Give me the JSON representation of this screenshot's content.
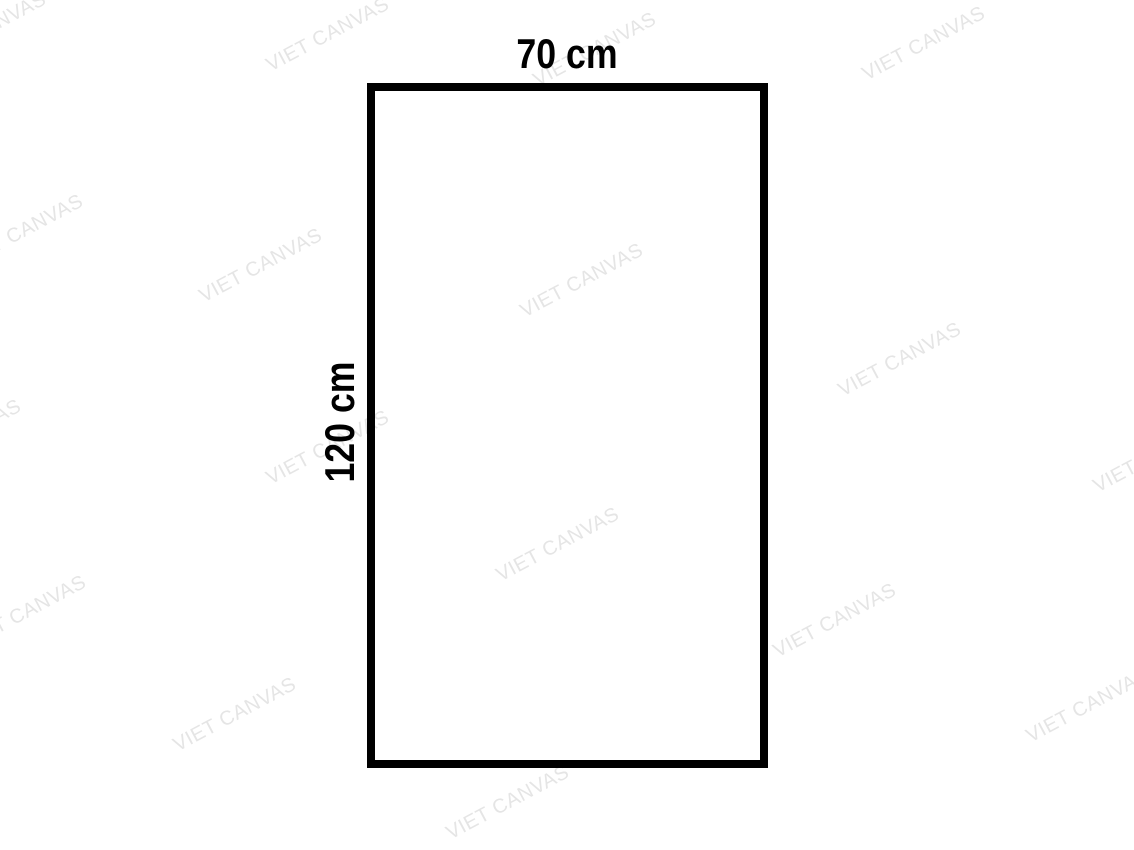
{
  "diagram": {
    "width_label": "70 cm",
    "height_label": "120 cm",
    "outline_color": "#000000",
    "label_color": "#000000",
    "background_color": "#ffffff"
  },
  "watermark": {
    "text": "VIET CANVAS",
    "color": "#e5e5e5",
    "angle_deg": -28,
    "positions": [
      {
        "x": -15,
        "y": 30
      },
      {
        "x": 328,
        "y": 35
      },
      {
        "x": 595,
        "y": 50
      },
      {
        "x": 924,
        "y": 44
      },
      {
        "x": 22,
        "y": 232
      },
      {
        "x": 261,
        "y": 266
      },
      {
        "x": 582,
        "y": 281
      },
      {
        "x": 900,
        "y": 360
      },
      {
        "x": 1155,
        "y": 456
      },
      {
        "x": -40,
        "y": 437
      },
      {
        "x": 328,
        "y": 448
      },
      {
        "x": 558,
        "y": 545
      },
      {
        "x": 25,
        "y": 613
      },
      {
        "x": 835,
        "y": 621
      },
      {
        "x": 235,
        "y": 715
      },
      {
        "x": 1088,
        "y": 706
      },
      {
        "x": 508,
        "y": 803
      }
    ]
  }
}
